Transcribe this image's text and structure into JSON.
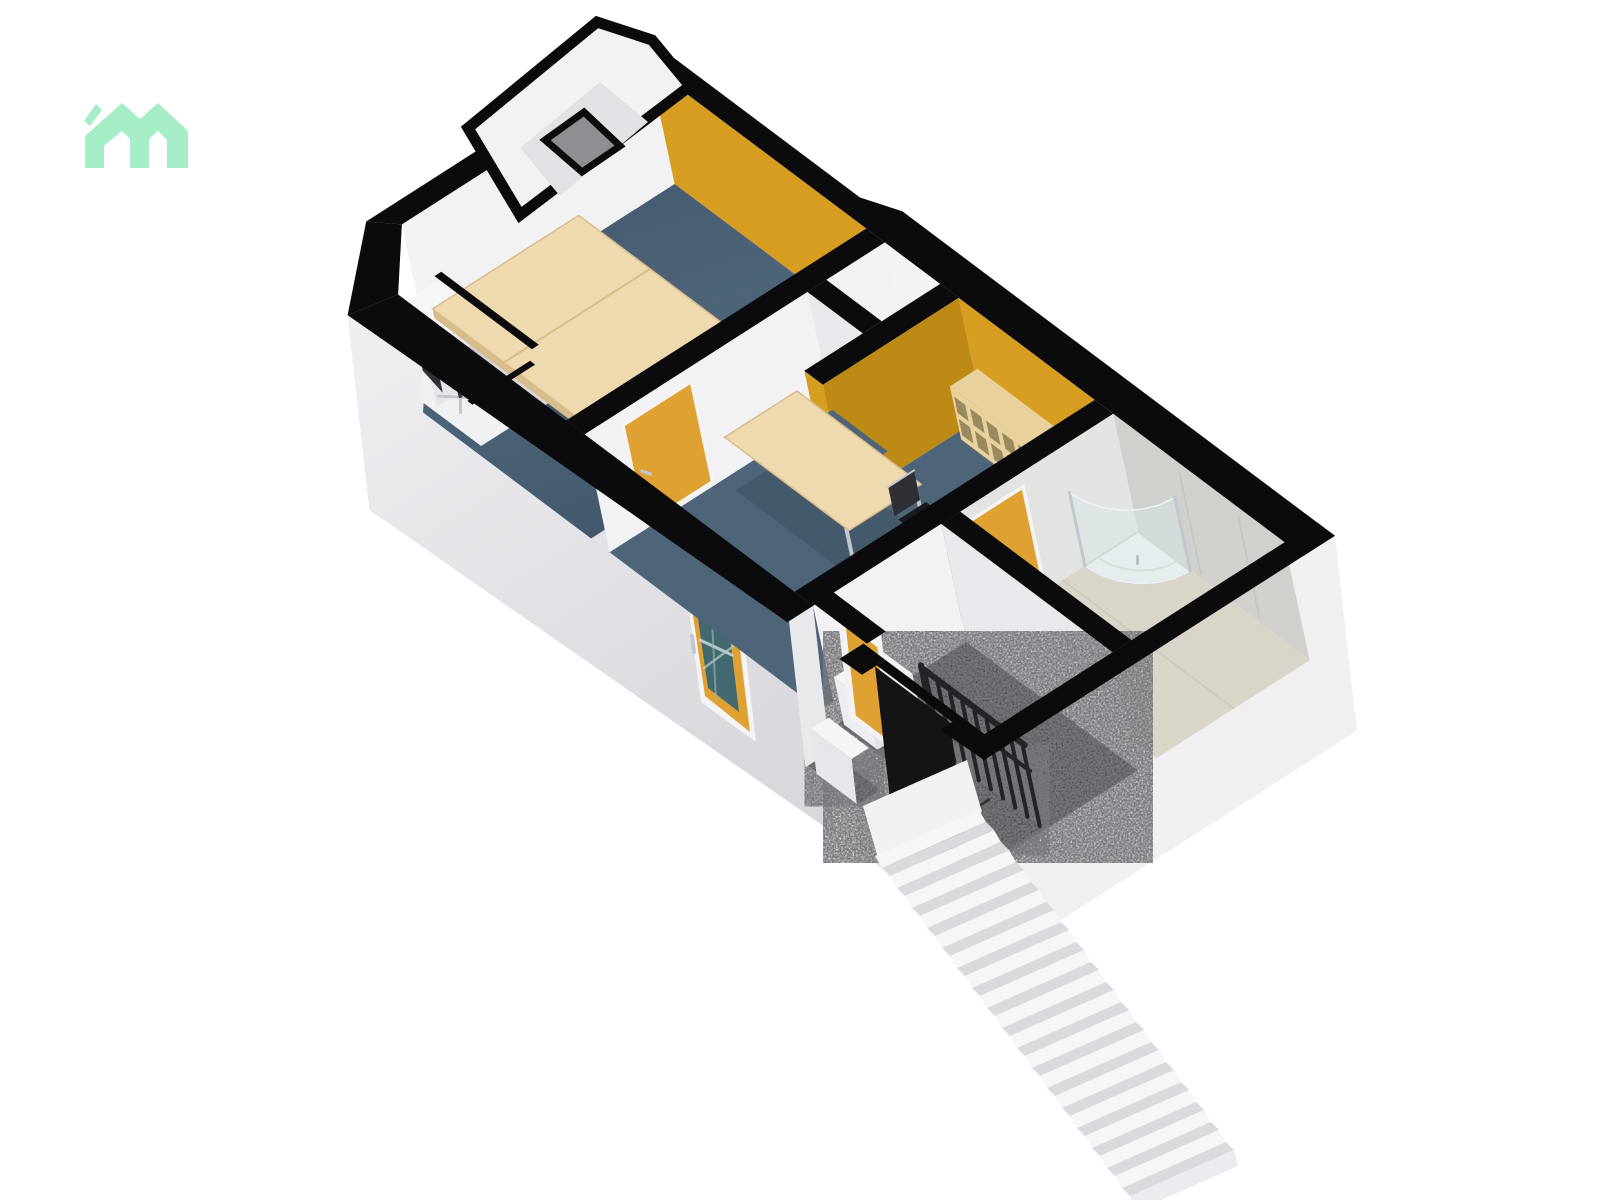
{
  "page": {
    "title": "3D Floor Plan View",
    "background": "#ffffff"
  },
  "logo": {
    "name": "floorplanner-logo",
    "color": "#a6eec8"
  },
  "palette": {
    "cap": "#0b0b0d",
    "ext_face_light": "#f0f0f3",
    "ext_face": "#e3e3e7",
    "ext_face_dark": "#d8d8dd",
    "wall_inner": "#f2f2f5",
    "wall_inner_dim": "#e9e9ed",
    "ochre": "#d79d20",
    "ochre_dark": "#bd8a16",
    "floor_blue": "#4d6479",
    "floor_blue_dark": "#43586c",
    "desk": "#efd9ae",
    "desk_edge": "#d8bc8b",
    "chair_dark": "#1a1a1e",
    "chair_mid": "#2f2f35",
    "metal": "#c3c7cd",
    "tile_light": "#e3e3e1",
    "tile_mid": "#d0d0cd",
    "tile_floor": "#d9d5c9",
    "hall_floor": "#26262a",
    "hole": "#121214",
    "stair_tread": "#f6f6f8",
    "stair_riser": "#d9d9de",
    "rail": "#242428",
    "door": "#dfa232",
    "glass": "#41696f",
    "shelf": "#e9d19e",
    "shelf_dark": "#d5b981",
    "shelf_slot": "#99895f",
    "shower_tray": "#f3f3f1",
    "shower_glass": "rgba(214,231,236,0.45)",
    "notch_slit": "#8e8e93"
  },
  "scene": {
    "type": "3d-floorplan-render",
    "rooms": [
      {
        "name": "office-1",
        "floor": "blue-carpet",
        "accent_wall": "ochre",
        "furniture": [
          "double-desk",
          "office-chair",
          "office-chair"
        ],
        "feature": "window-nook"
      },
      {
        "name": "office-2",
        "floor": "blue-carpet",
        "accent_wall": "ochre",
        "furniture": [
          "work-table",
          "office-chair",
          "cubby-shelf"
        ]
      },
      {
        "name": "bathroom",
        "floor": "tile",
        "walls": "tile",
        "furniture": [
          "corner-shower"
        ]
      },
      {
        "name": "hallway",
        "floor": "dark-speckle",
        "furniture": [
          "stair-railing",
          "white-step"
        ]
      }
    ],
    "doors": {
      "entry_glass_door": 1,
      "interior_orange_doors": 3
    },
    "stairs": {
      "exterior_step_count": 17,
      "interior_railing_balusters": 8
    }
  }
}
